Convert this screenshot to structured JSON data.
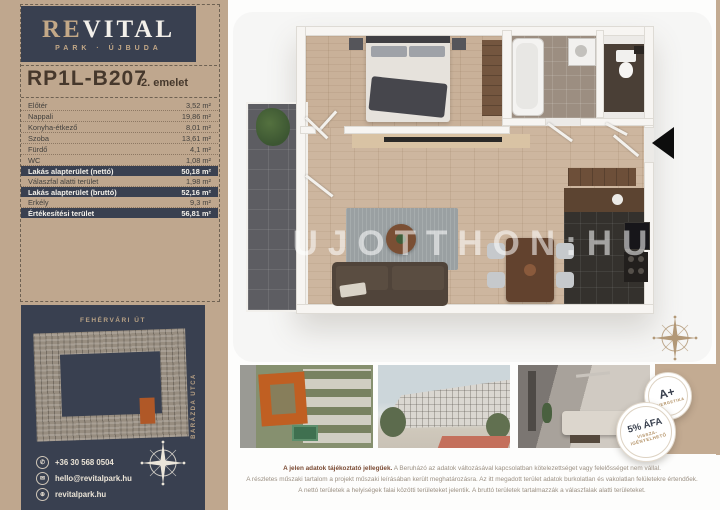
{
  "brand": {
    "logo_first": "RE",
    "logo_rest": "VITAL",
    "tagline": "PARK · ÚJBUDA"
  },
  "unit": {
    "code": "RP1L-B207",
    "floor_label": "2. emelet"
  },
  "area_table": {
    "rows": [
      {
        "label": "Előtér",
        "value": "3,52 m²"
      },
      {
        "label": "Nappali",
        "value": "19,86 m²"
      },
      {
        "label": "Konyha-étkező",
        "value": "8,01 m²"
      },
      {
        "label": "Szoba",
        "value": "13,61 m²"
      },
      {
        "label": "Fürdő",
        "value": "4,1 m²"
      },
      {
        "label": "WC",
        "value": "1,08 m²"
      },
      {
        "label": "Lakás alapterület (nettó)",
        "value": "50,18 m²"
      },
      {
        "label": "Válaszfal alatti terület",
        "value": "1,98 m²"
      },
      {
        "label": "Lakás alapterület (bruttó)",
        "value": "52,16 m²"
      },
      {
        "label": "Erkély",
        "value": "9,3 m²"
      },
      {
        "label": "Értékesítési terület",
        "value": "56,81 m²"
      }
    ]
  },
  "site_map": {
    "street_top": "FEHÉRVÁRI ÚT",
    "street_right": "BARÁZDA UTCA"
  },
  "contact": {
    "phone": "+36 30 568 0504",
    "email": "hello@revitalpark.hu",
    "website": "revitalpark.hu"
  },
  "floorplan": {
    "watermark": "UJOTTHON:HU"
  },
  "badges": {
    "energy": {
      "title": "A+",
      "subtitle": "ENERGETIKA"
    },
    "vat": {
      "title": "5% ÁFA",
      "line1": "VISSZA-",
      "line2": "IGÉNYELHETŐ"
    }
  },
  "disclaimer": {
    "line1_bold": "A jelen adatok tájékoztató jellegűek.",
    "line1_rest": " A Beruházó az adatok változásával kapcsolatban kötelezettséget vagy felelősséget nem vállal.",
    "line2": "A részletes műszaki tartalom a projekt műszaki leírásában került meghatározásra. Az itt megadott terület adatok burkolatlan és vakolatlan felületekre értendőek.",
    "line3": "A nettó területek a helyiségek falai közötti területeket jelentik. A bruttó területek tartalmazzák a válaszfalak alatti területeket."
  },
  "colors": {
    "accent_tan": "#bfa78e",
    "panel_navy": "#394050",
    "highlight_orange": "#b05827",
    "title_brown": "#46382c"
  }
}
